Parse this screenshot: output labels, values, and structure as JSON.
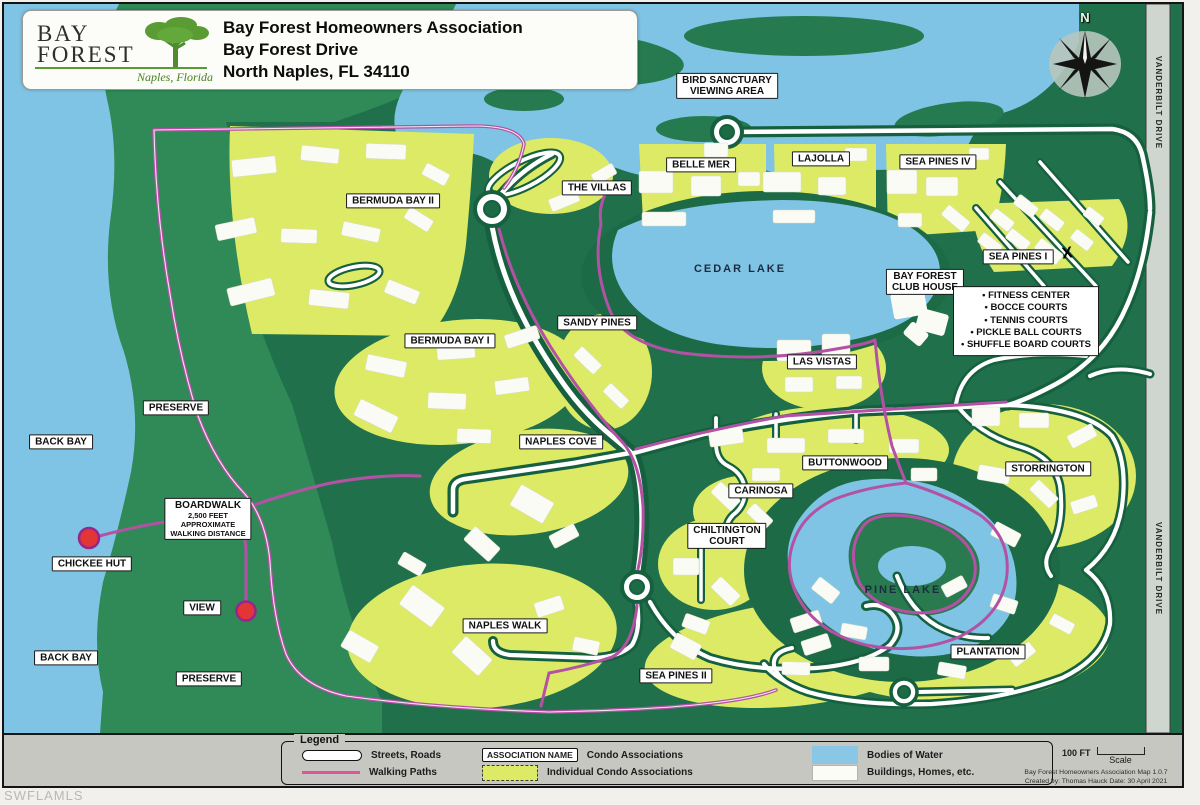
{
  "frame": {
    "watermark": "SWFLAMLS"
  },
  "title_block": {
    "logo_name_line1": "BAY",
    "logo_name_line2": "FOREST",
    "logo_subtitle": "Naples, Florida",
    "line1": "Bay Forest Homeowners Association",
    "line2": "Bay Forest Drive",
    "line3": "North Naples, FL 34110"
  },
  "compass": {
    "north": "N"
  },
  "vanderbilt": {
    "top": "VANDERBILT DRIVE",
    "bottom": "VANDERBILT DRIVE"
  },
  "marks": {
    "sea_pines_x": "X"
  },
  "map_labels": {
    "bird_sanctuary": "BIRD SANCTUARY\nVIEWING AREA",
    "belle_mer": "BELLE MER",
    "lajolla": "LAJOLLA",
    "sea_pines_iv": "SEA PINES IV",
    "the_villas": "THE VILLAS",
    "bermuda_bay_ii": "BERMUDA BAY II",
    "sea_pines_i": "SEA PINES I",
    "cedar_lake": "CEDAR LAKE",
    "club_house": "BAY FOREST\nCLUB HOUSE",
    "amenities": "• FITNESS CENTER\n• BOCCE COURTS\n• TENNIS COURTS\n• PICKLE BALL COURTS\n• SHUFFLE BOARD COURTS",
    "sandy_pines": "SANDY PINES",
    "bermuda_bay_i": "BERMUDA BAY I",
    "las_vistas": "LAS VISTAS",
    "preserve_upper": "PRESERVE",
    "back_bay_upper": "BACK BAY",
    "naples_cove": "NAPLES COVE",
    "buttonwood": "BUTTONWOOD",
    "storrington": "STORRINGTON",
    "carinosa": "CARINOSA",
    "boardwalk_title": "BOARDWALK",
    "boardwalk_sub": "2,500 FEET\nAPPROXIMATE\nWALKING DISTANCE",
    "chiltington_court": "CHILTINGTON\nCOURT",
    "chickee_hut": "CHICKEE HUT",
    "pine_lake": "PINE LAKE",
    "view": "VIEW",
    "naples_walk": "NAPLES WALK",
    "back_bay_lower": "BACK BAY",
    "plantation": "PLANTATION",
    "preserve_lower": "PRESERVE",
    "sea_pines_ii": "SEA PINES II"
  },
  "legend": {
    "title": "Legend",
    "streets_roads": "Streets, Roads",
    "walking_paths": "Walking Paths",
    "association_name": "ASSOCIATION NAME",
    "condo_associations": "Condo Associations",
    "individual_condo": "Individual Condo Associations",
    "bodies_of_water": "Bodies of Water",
    "buildings_homes": "Buildings, Homes, etc."
  },
  "scale": {
    "distance": "100 FT",
    "label": "Scale"
  },
  "credits": {
    "line1": "Bay Forest Homeowners Association Map 1.0.7",
    "line2": "Created by: Thomas Hauck  Date: 30 April 2021"
  },
  "colors": {
    "water": "#7fc4e4",
    "condo_yellow": "#dcea66",
    "preserve_dark_green": "#20714b",
    "mid_green": "#2f8a57",
    "road_casing": "#16603f",
    "walking_path": "#b352a4",
    "marker_red": "#e23535"
  }
}
